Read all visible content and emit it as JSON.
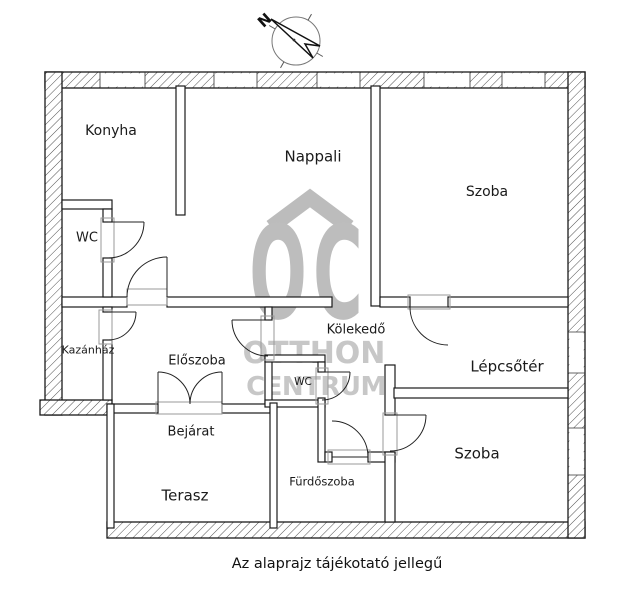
{
  "compass": {
    "north_label": "N"
  },
  "watermark": {
    "initials": "OC",
    "line1": "OTTHON",
    "line2": "CENTRUM",
    "color": "#c3c3c3"
  },
  "rooms": [
    {
      "id": "konyha",
      "label": "Konyha"
    },
    {
      "id": "nappali",
      "label": "Nappali"
    },
    {
      "id": "szoba-top",
      "label": "Szoba"
    },
    {
      "id": "wc-left",
      "label": "WC"
    },
    {
      "id": "kazanhaz",
      "label": "Kazánház"
    },
    {
      "id": "eloszoba",
      "label": "Előszoba"
    },
    {
      "id": "kolekedo",
      "label": "Kölekedő"
    },
    {
      "id": "lepcsoter",
      "label": "Lépcsőtér"
    },
    {
      "id": "wc-small",
      "label": "WC"
    },
    {
      "id": "bejarat",
      "label": "Bejárat"
    },
    {
      "id": "furdoszoba",
      "label": "Fürdőszoba"
    },
    {
      "id": "terasz",
      "label": "Terasz"
    },
    {
      "id": "szoba-bottom",
      "label": "Szoba"
    }
  ],
  "caption": "Az alaprajz tájékotató jellegű"
}
